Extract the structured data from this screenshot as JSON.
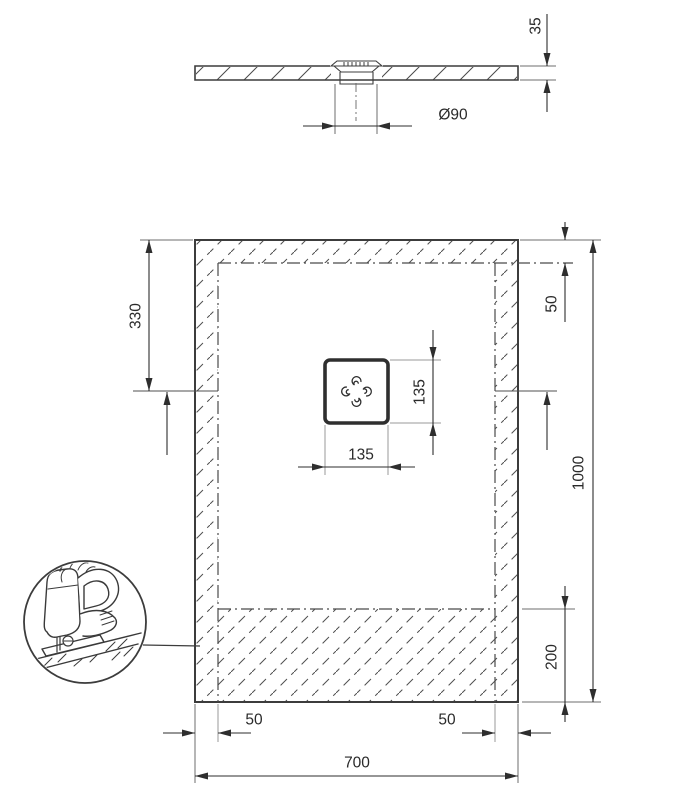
{
  "drawing": {
    "section": {
      "thickness": "35",
      "drain_diameter": "Ø90"
    },
    "plan": {
      "width": "700",
      "height": "1000",
      "drain_center_from_top": "330",
      "top_inset": "50",
      "left_inset": "50",
      "right_inset": "50",
      "cut_zone_height": "200",
      "drain_size_vertical": "135",
      "drain_size_horizontal": "135"
    },
    "icons": {
      "cut_detail": "jigsaw-cuttable-zone"
    },
    "colors": {
      "outline": "#3c3c3c",
      "dimension": "#2e2e2e",
      "extension": "#9a9a9a",
      "background": "#ffffff"
    }
  }
}
